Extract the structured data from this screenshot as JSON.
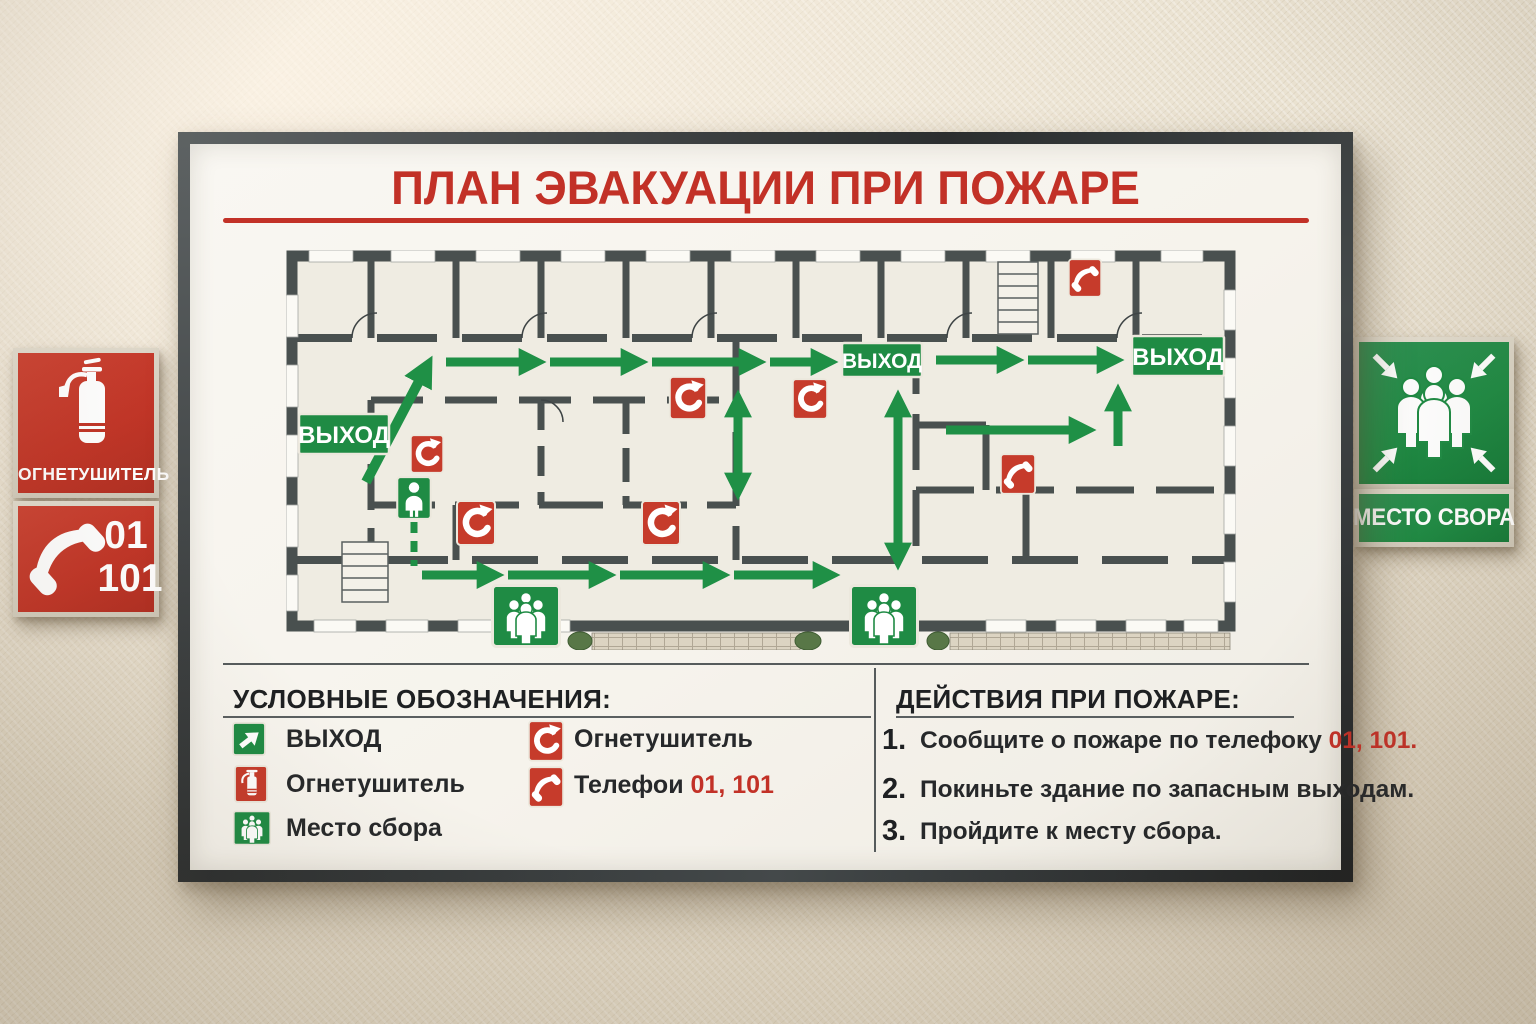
{
  "board": {
    "title": "ПЛАН ЭВАКУАЦИИ ПРИ ПОЖАРЕ",
    "plan": {
      "exits": [
        "ВЫХОД",
        "ВЫХОД",
        "ВЫХОД"
      ]
    },
    "legend": {
      "heading": "УСЛОВНЫЕ ОБОЗНАЧЕНИЯ:",
      "items": [
        {
          "icon": "exit-arrow-icon",
          "label": "ВЫХОД"
        },
        {
          "icon": "fire-extinguisher-icon",
          "label": "Огнетушитель"
        },
        {
          "icon": "assembly-point-icon",
          "label": "Место сбора"
        },
        {
          "icon": "extinguisher-handset-icon",
          "label": "Огнетушитель"
        },
        {
          "icon": "telephone-handset-icon",
          "label": "Телефои",
          "numbers": "01, 101"
        }
      ]
    },
    "actions": {
      "heading": "ДЕЙСТВИЯ ПРИ ПОЖАРЕ:",
      "items": [
        {
          "num": "1.",
          "text": "Сообщите о пожаре по телефоку ",
          "highlight": "01, 101."
        },
        {
          "num": "2.",
          "text": "Покиньте здание по запасным выходам.",
          "highlight": ""
        },
        {
          "num": "3.",
          "text": "Пройдите к месту сбора.",
          "highlight": ""
        }
      ]
    }
  },
  "wall_signs": {
    "extinguisher_label": "ОГНЕТУШИТЕЛЬ",
    "phone": {
      "num1": "01",
      "num2": "101"
    },
    "assembly_label": "МЕСТО СВОРА"
  },
  "colors": {
    "accent_red": "#c23127",
    "sign_green": "#1f8b44",
    "wall_dark": "#49504f"
  }
}
